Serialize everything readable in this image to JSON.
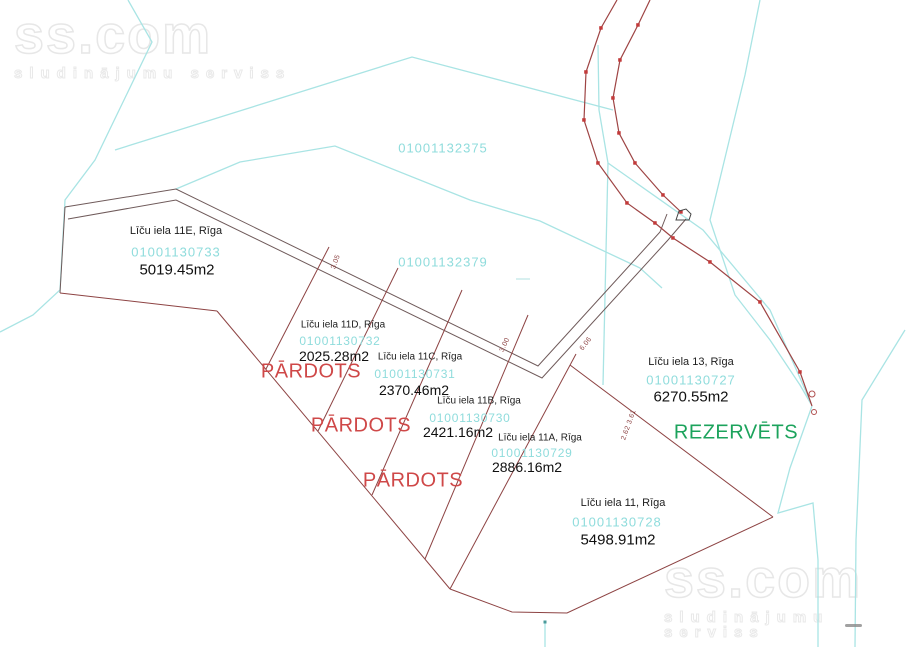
{
  "map": {
    "watermark": {
      "brand": "ss.com",
      "tagline": "sludinājumu serviss"
    },
    "large_parcels": [
      {
        "id": "01001132375"
      },
      {
        "id": "01001132379"
      }
    ],
    "plots": [
      {
        "title": "Līču iela 11E, Rīga",
        "cadastre": "01001130733",
        "area": "5019.45m2"
      },
      {
        "title": "Līču iela 11D, Rīga",
        "cadastre": "01001130732",
        "area": "2025.28m2"
      },
      {
        "title": "Līču iela 11C, Rīga",
        "cadastre": "01001130731",
        "area": "2370.46m2"
      },
      {
        "title": "Līču iela 11B, Rīga",
        "cadastre": "01001130730",
        "area": "2421.16m2"
      },
      {
        "title": "Līču iela 11A, Rīga",
        "cadastre": "01001130729",
        "area": "2886.16m2"
      },
      {
        "title": "Līču iela 13, Rīga",
        "cadastre": "01001130727",
        "area": "6270.55m2"
      },
      {
        "title": "Līču iela 11, Rīga",
        "cadastre": "01001130728",
        "area": "5498.91m2"
      }
    ],
    "statuses": [
      {
        "label": "PĀRDOTS"
      },
      {
        "label": "PĀRDOTS"
      },
      {
        "label": "PĀRDOTS"
      },
      {
        "label": "REZERVĒTS"
      }
    ],
    "dimensions": [
      {
        "text": "3.05"
      },
      {
        "text": "3.00"
      },
      {
        "text": "6.06"
      },
      {
        "text": "2.62 3.61"
      }
    ],
    "colors": {
      "cadastre_text": "#8FDCDC",
      "boundary_cyan": "#A9E4E4",
      "subdivision_red": "#8D4343",
      "strip_gray": "#6F5A5A",
      "road_marker_red": "#C23A3A",
      "sold_red": "#CF4848",
      "reserved_green": "#1CA35C"
    }
  }
}
